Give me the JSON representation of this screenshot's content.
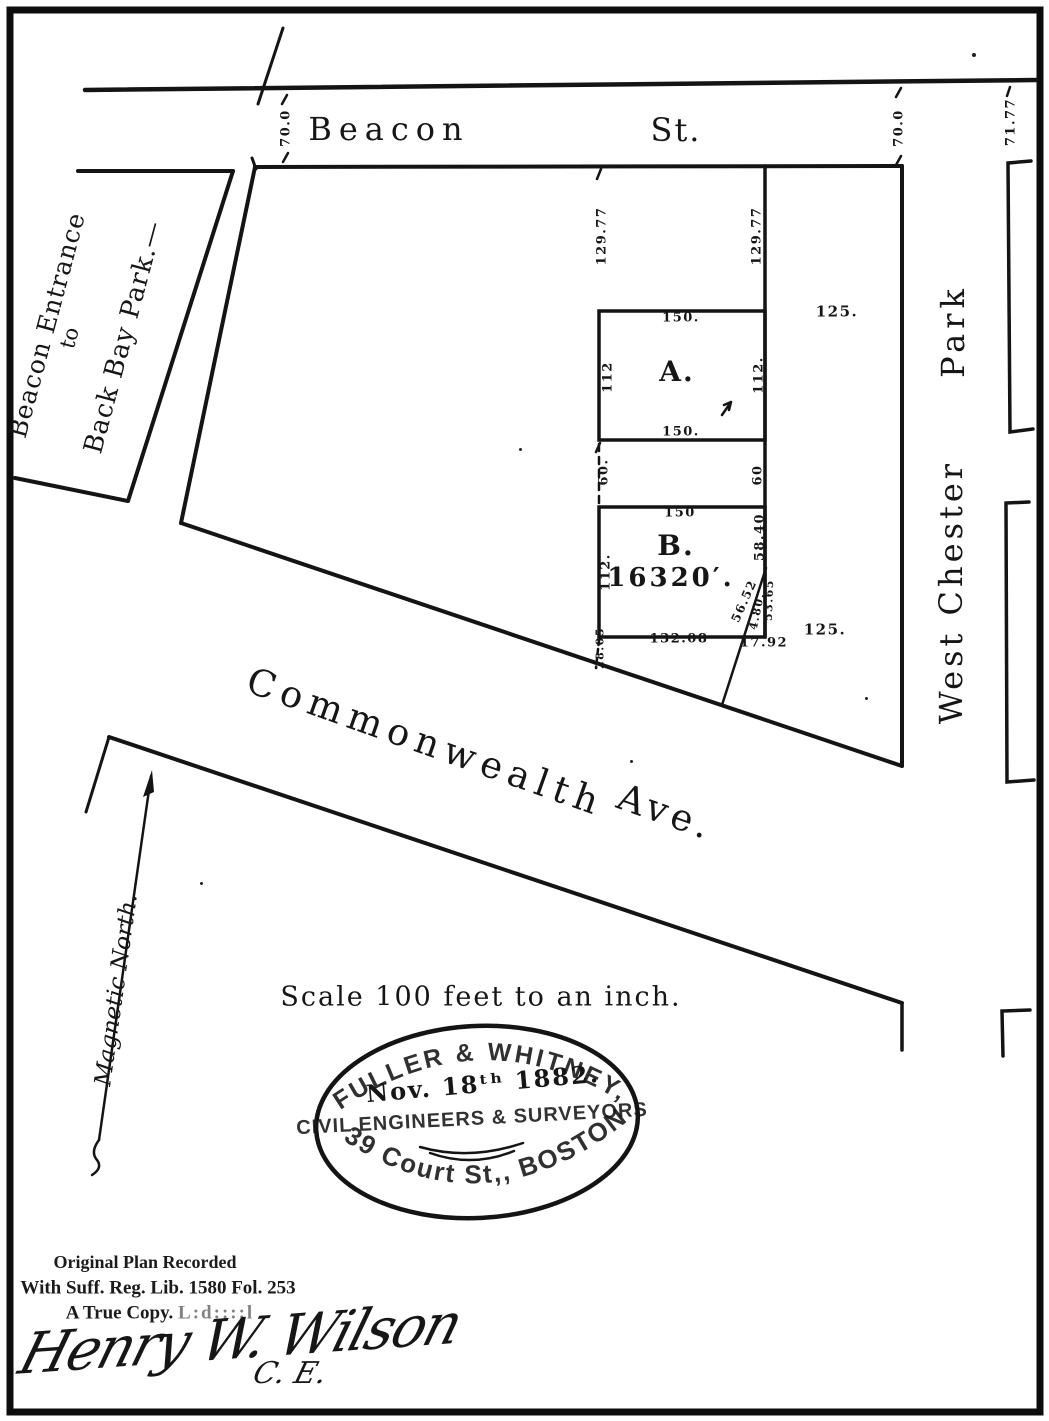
{
  "colors": {
    "ink": "#141414",
    "paper": "#ffffff"
  },
  "streets": {
    "beacon_name": "Beacon",
    "beacon_suffix": "St.",
    "commonwealth_name": "Commonwealth",
    "commonwealth_suffix": "Ave.",
    "west_chester": "West Chester",
    "park": "Park",
    "entrance_line1": "Beacon Entrance",
    "entrance_line2": "to",
    "entrance_line3": "Back Bay Park.—",
    "magnetic_north": "Magnetic North."
  },
  "parcels": {
    "a_label": "A.",
    "b_label": "B.",
    "b_area": "16320′."
  },
  "dims": {
    "beacon_width_left": "70.0",
    "beacon_width_right": "70.0",
    "park_width": "71.77",
    "depth_left": "129.77",
    "depth_right": "129.77",
    "east_lot_top": "125.",
    "east_lot_bottom": "125.",
    "a_top": "150.",
    "a_bottom": "150.",
    "a_left": "112",
    "a_right": "112.",
    "gap_left": "60.",
    "gap_right": "60",
    "b_top": "150",
    "b_left": "112.",
    "b_right_upper": "58.40",
    "b_right_lower": "53.65",
    "b_diagonal": "56.52",
    "b_diagonal_small": "4.80.",
    "b_bottom_main": "132.08",
    "b_bottom_right": "17.92",
    "b_stub": "28.05"
  },
  "notes": {
    "scale": "Scale 100 feet to an inch."
  },
  "stamp": {
    "firm": "FULLER & WHITNEY,",
    "date": "Nov. 18ᵗʰ 1882.",
    "profession": "CIVIL ENGINEERS & SURVEYORS",
    "address": "39 Court St,, BOSTON."
  },
  "recording": {
    "line1": "Original Plan Recorded",
    "line2": "With Suff. Reg. Lib. 1580 Fol. 253",
    "line3": "A True Copy.",
    "illegible": "L:d::::l",
    "signature": "Henry W. Wilson",
    "signature_title": "C. E."
  }
}
